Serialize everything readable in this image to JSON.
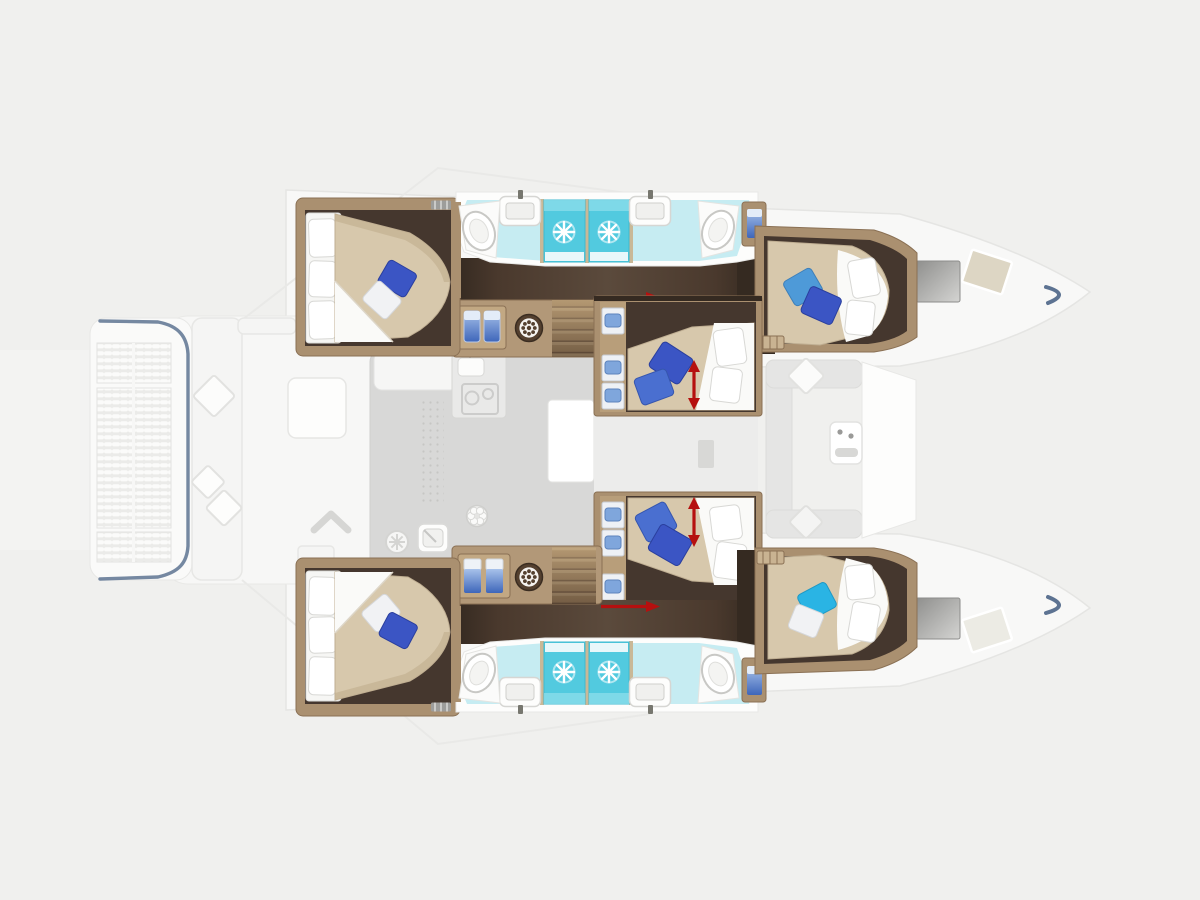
{
  "diagram": {
    "kind": "yacht-floor-plan",
    "vessel": "sailing catamaran, top view, bows to the right",
    "visible_text": [],
    "rooms": {
      "hull_cabins": [
        {
          "id": "aft-cabin-port",
          "position": "top-left",
          "bed": "double",
          "pillows": [
            "navy",
            "white"
          ]
        },
        {
          "id": "forward-cabin-port",
          "position": "top-right",
          "bed": "double",
          "pillows": [
            "sky-blue",
            "navy"
          ]
        },
        {
          "id": "aft-cabin-starboard",
          "position": "bottom-left",
          "bed": "double",
          "pillows": [
            "white",
            "navy"
          ]
        },
        {
          "id": "forward-cabin-starboard",
          "position": "bottom-right",
          "bed": "double",
          "pillows": [
            "cyan",
            "white"
          ]
        }
      ],
      "center_cabins": [
        {
          "id": "center-cabin-upper",
          "bed": "double",
          "pillows": [
            "navy",
            "blue"
          ],
          "dimension_arrow": true
        },
        {
          "id": "center-cabin-lower",
          "bed": "double",
          "pillows": [
            "blue",
            "navy"
          ],
          "dimension_arrow": true
        }
      ],
      "bathrooms": [
        {
          "id": "bathroom-port",
          "position": "top",
          "fixtures": [
            "toilet",
            "sink",
            "shower",
            "shower",
            "sink",
            "toilet",
            "towel-locker"
          ]
        },
        {
          "id": "bathroom-starboard",
          "position": "bottom",
          "fixtures": [
            "toilet",
            "sink",
            "shower",
            "shower",
            "sink",
            "toilet",
            "towel-locker"
          ]
        }
      ],
      "corridors": [
        {
          "id": "companionway-port",
          "features": [
            "stairs",
            "towel-locker",
            "washing-machine"
          ]
        },
        {
          "id": "companionway-starboard",
          "features": [
            "stairs",
            "wardrobe-shirts",
            "washing-machine"
          ]
        }
      ],
      "salon": {
        "features": [
          "galley-counter",
          "galley-sink",
          "stove",
          "floor-mat",
          "vent-fan",
          "sink-square"
        ]
      },
      "forward_cockpit": {
        "features": [
          "u-bench",
          "console-table",
          "deck-hatch",
          "locker-chevron"
        ]
      },
      "exterior": [
        "aft-platform-slats",
        "transom-edge",
        "cockpit-bench",
        "cockpit-table",
        "bow-hull-windows",
        "bow-deck-hatches",
        "bow-tips"
      ]
    },
    "annotations": {
      "dimension_arrows_count": 4,
      "arrow_color": "red"
    }
  },
  "colors": {
    "bg": "#f0f0ee",
    "deck": "#f8f8f7",
    "deck_stroke": "#e5e5e3",
    "bridge": "#f3f3f2",
    "salon": "#d8d8d7",
    "salon_gap": "#ececeb",
    "wood": "#aa9070",
    "wood_light": "#c2a883",
    "wood_shelf": "#b29878",
    "wood_dark": "#8a7054",
    "floor": "#45372e",
    "floor_dark": "#352a21",
    "corridor_mid": "#5b4a3c",
    "mattress": "#d7c8ac",
    "mattress_shade": "#c3b192",
    "sheet": "#fafaf8",
    "cushion": "#f6f6f4",
    "pillow_navy": "#3b55c4",
    "pillow_blue": "#4a6fd0",
    "pillow_sky": "#4e9ad8",
    "pillow_cyan": "#2ab4e4",
    "pillow_white": "#f1f2f4",
    "bath": "#c6ecf2",
    "shower": "#52cadf",
    "shower_light": "#8adcea",
    "towel_top": "#a8c2ea",
    "towel_bottom": "#3e66ba",
    "red": "#b5100f",
    "transom": "#5d7392",
    "window_dark": "#8f8f8d",
    "window_light": "#d4d4d2",
    "hatch_tan": "#ddd6c4",
    "step_light": "#bfa47e",
    "step_dark": "#4a382a"
  }
}
